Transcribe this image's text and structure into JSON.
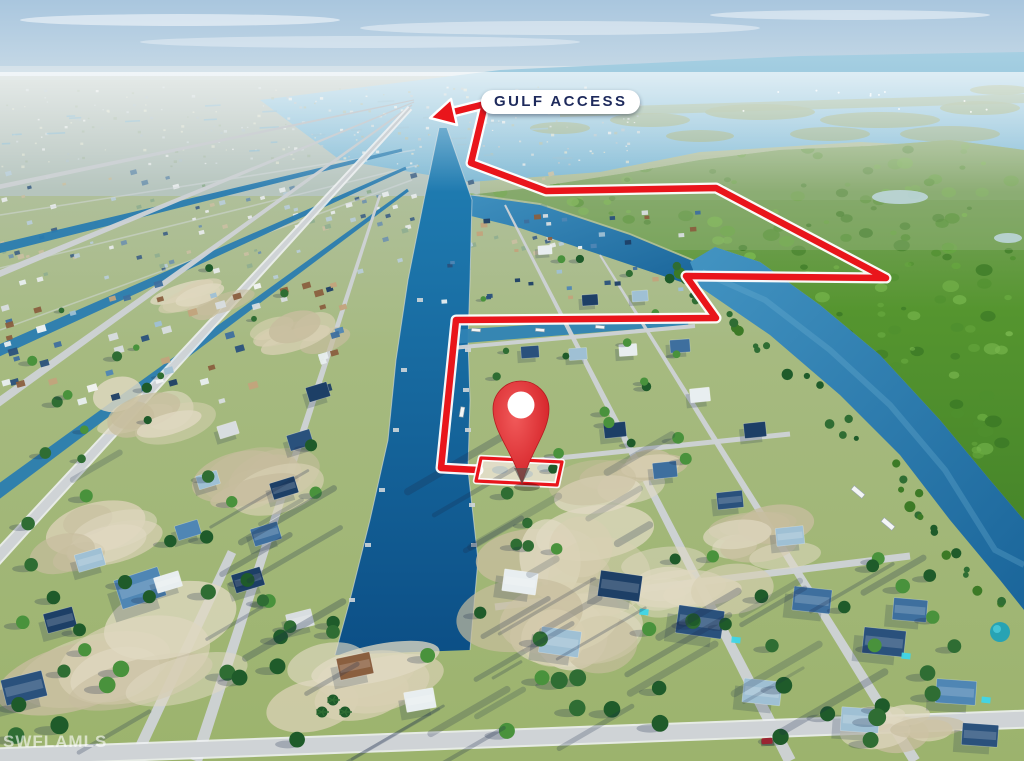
{
  "annotations": {
    "gulf_access_label": "GULF ACCESS",
    "watermark": "SWFLAMLS"
  },
  "colors": {
    "route_red": "#e9151b",
    "casing_white": "#ffffff",
    "label_text": "#1e2a5c",
    "label_bg": "#ffffff",
    "pin_red": "#e02a2e",
    "pin_red_dark": "#b51b20",
    "pin_tip": "#57514d",
    "pin_inner": "#ffffff",
    "watermark": "rgba(255,255,255,0.6)",
    "sky_top": "#a9c6de",
    "bay_blue": "#8fc2dc",
    "canal_blue": "#0f5a8f",
    "river_blue": "#2a80b2",
    "preserve_green": "#55952f",
    "land_green": "#a6ba80",
    "street_grey": "#cdd2d5",
    "curb_white": "#eef1f2",
    "sand": "#d8d0b3",
    "sand_dark": "#c7bd9e",
    "shadow": "rgba(26,43,74,0.25)",
    "tree_green": "#2f6d33",
    "car_red": "#c4232a"
  },
  "overlay": {
    "route_points": [
      [
        441,
        115
      ],
      [
        485,
        104
      ],
      [
        471,
        163
      ],
      [
        546,
        191
      ],
      [
        716,
        188
      ],
      [
        886,
        278
      ],
      [
        686,
        276
      ],
      [
        716,
        318
      ],
      [
        456,
        320
      ],
      [
        441,
        468
      ],
      [
        478,
        470
      ]
    ],
    "arrow_head": [
      [
        430,
        118
      ],
      [
        451,
        99
      ],
      [
        457,
        125
      ]
    ],
    "lot_outline": [
      [
        481,
        458
      ],
      [
        562,
        462
      ],
      [
        557,
        485
      ],
      [
        476,
        481
      ]
    ],
    "pin": {
      "cx": 521,
      "cy": 409,
      "r": 28,
      "inner_r": 13.5,
      "tip_x": 522,
      "tip_y": 484
    }
  },
  "scene": {
    "clouds": [
      [
        180,
        20,
        160,
        6,
        0.5
      ],
      [
        560,
        28,
        200,
        7,
        0.4
      ],
      [
        850,
        15,
        140,
        5,
        0.45
      ],
      [
        360,
        42,
        220,
        6,
        0.35
      ]
    ],
    "bay": [
      [
        260,
        100
      ],
      [
        500,
        70
      ],
      [
        800,
        56
      ],
      [
        1024,
        52
      ],
      [
        1024,
        150
      ],
      [
        860,
        142
      ],
      [
        700,
        152
      ],
      [
        600,
        172
      ],
      [
        470,
        182
      ],
      [
        340,
        160
      ]
    ],
    "shoreline": [
      [
        560,
        108
      ],
      [
        1024,
        94
      ],
      [
        1024,
        103
      ],
      [
        560,
        117
      ]
    ],
    "islands": [
      [
        650,
        120,
        40,
        7
      ],
      [
        760,
        112,
        55,
        8
      ],
      [
        880,
        120,
        60,
        8
      ],
      [
        980,
        108,
        40,
        7
      ],
      [
        560,
        128,
        30,
        6
      ],
      [
        700,
        136,
        34,
        6
      ],
      [
        830,
        134,
        40,
        7
      ],
      [
        950,
        134,
        50,
        8
      ],
      [
        1000,
        90,
        30,
        5
      ],
      [
        590,
        100,
        26,
        5
      ]
    ],
    "preserve": [
      [
        432,
        188
      ],
      [
        540,
        203
      ],
      [
        630,
        233
      ],
      [
        695,
        260
      ],
      [
        715,
        247
      ],
      [
        760,
        262
      ],
      [
        820,
        305
      ],
      [
        880,
        355
      ],
      [
        940,
        420
      ],
      [
        990,
        480
      ],
      [
        1024,
        520
      ],
      [
        1024,
        150
      ],
      [
        950,
        140
      ],
      [
        870,
        146
      ],
      [
        780,
        150
      ],
      [
        700,
        160
      ],
      [
        620,
        174
      ],
      [
        530,
        188
      ],
      [
        460,
        196
      ]
    ],
    "ponds": [
      [
        668,
        152,
        16,
        5
      ],
      [
        900,
        197,
        28,
        7
      ],
      [
        1008,
        238,
        14,
        5
      ],
      [
        648,
        142,
        10,
        4
      ]
    ],
    "marsh_mute": [
      [
        430,
        140,
        594,
        110,
        0.35
      ],
      [
        600,
        140,
        424,
        60,
        0.3
      ]
    ],
    "upper_canal": [
      [
        432,
        190
      ],
      [
        540,
        205
      ],
      [
        630,
        235
      ],
      [
        695,
        262
      ],
      [
        690,
        285
      ],
      [
        610,
        258
      ],
      [
        520,
        228
      ],
      [
        430,
        206
      ]
    ],
    "river": {
      "left": [
        [
          690,
          262
        ],
        [
          700,
          287
        ],
        [
          770,
          335
        ],
        [
          840,
          395
        ],
        [
          900,
          455
        ],
        [
          950,
          520
        ],
        [
          1000,
          580
        ],
        [
          1024,
          610
        ]
      ],
      "right": [
        [
          1024,
          520
        ],
        [
          990,
          480
        ],
        [
          940,
          420
        ],
        [
          880,
          355
        ],
        [
          820,
          305
        ],
        [
          760,
          262
        ],
        [
          715,
          247
        ]
      ],
      "center": [
        [
          702,
          272
        ],
        [
          765,
          300
        ],
        [
          830,
          350
        ],
        [
          890,
          405
        ],
        [
          945,
          470
        ],
        [
          995,
          550
        ],
        [
          1024,
          565
        ]
      ]
    },
    "central_canal": {
      "left": [
        [
          439,
          128
        ],
        [
          424,
          200
        ],
        [
          408,
          280
        ],
        [
          396,
          360
        ],
        [
          388,
          440
        ],
        [
          370,
          520
        ],
        [
          350,
          600
        ],
        [
          335,
          655
        ]
      ],
      "right": [
        [
          447,
          128
        ],
        [
          472,
          200
        ],
        [
          470,
          280
        ],
        [
          468,
          340
        ],
        [
          470,
          400
        ],
        [
          468,
          470
        ],
        [
          478,
          560
        ],
        [
          470,
          650
        ]
      ]
    },
    "canal_strips": [
      [
        [
          402,
          150
        ],
        [
          -40,
          258
        ],
        3,
        10
      ],
      [
        [
          406,
          168
        ],
        [
          -40,
          368
        ],
        3,
        12
      ],
      [
        [
          408,
          190
        ],
        [
          -40,
          520
        ],
        3,
        14
      ],
      [
        [
          452,
          337
        ],
        [
          688,
          320
        ],
        14,
        10
      ]
    ],
    "faint_cross_streets": [
      [
        [
          0,
          215
        ],
        [
          415,
          150
        ]
      ],
      [
        [
          0,
          268
        ],
        [
          418,
          165
        ]
      ],
      [
        [
          0,
          330
        ],
        [
          412,
          180
        ]
      ]
    ],
    "streets": [
      [
        [
          414,
          100
        ],
        [
          -40,
          195
        ],
        1,
        5,
        0
      ],
      [
        [
          414,
          102
        ],
        [
          -40,
          290
        ],
        1,
        7,
        0
      ],
      [
        [
          412,
          105
        ],
        [
          -40,
          430
        ],
        1.5,
        9,
        0
      ],
      [
        [
          410,
          108
        ],
        [
          -60,
          620
        ],
        2,
        11,
        1
      ],
      [
        [
          380,
          195
        ],
        [
          196,
          761
        ],
        2.5,
        12,
        0
      ],
      [
        [
          232,
          552
        ],
        [
          138,
          752
        ],
        9,
        11,
        0
      ],
      [
        [
          505,
          205
        ],
        [
          790,
          761
        ],
        2,
        12,
        0
      ],
      [
        [
          600,
          255
        ],
        [
          915,
          761
        ],
        2,
        11,
        0
      ],
      [
        [
          452,
          348
        ],
        [
          695,
          326
        ],
        4,
        4,
        0
      ],
      [
        [
          462,
          468
        ],
        [
          790,
          434
        ],
        5,
        5,
        0
      ],
      [
        [
          495,
          607
        ],
        [
          910,
          556
        ],
        7,
        7,
        0
      ],
      [
        [
          -5,
          757
        ],
        [
          1029,
          719
        ],
        15,
        15,
        1
      ]
    ],
    "sand_zones": [
      [
        130,
        650,
        120,
        55,
        -15
      ],
      [
        360,
        690,
        100,
        45,
        -12
      ],
      [
        555,
        545,
        80,
        55,
        -8
      ],
      [
        565,
        640,
        90,
        50,
        -8
      ],
      [
        700,
        580,
        70,
        35,
        -6
      ],
      [
        245,
        480,
        70,
        35,
        -16
      ],
      [
        150,
        410,
        60,
        30,
        -16
      ],
      [
        80,
        540,
        70,
        35,
        -15
      ],
      [
        620,
        480,
        60,
        30,
        -8
      ],
      [
        760,
        540,
        55,
        28,
        -6
      ],
      [
        300,
        330,
        50,
        22,
        -18
      ],
      [
        200,
        300,
        45,
        20,
        -18
      ],
      [
        905,
        720,
        60,
        25,
        -4
      ]
    ],
    "roof_palette": [
      "#1d3f66",
      "#2a517c",
      "#3e6f9e",
      "#4f86b4",
      "#9fc0d4",
      "#e8eef0",
      "#f2f4f4",
      "#c2a37c",
      "#8a5f3f",
      "#d8dde0"
    ],
    "houses": [
      [
        140,
        588,
        46,
        30,
        -18,
        3
      ],
      [
        24,
        688,
        42,
        26,
        -14,
        1
      ],
      [
        355,
        666,
        34,
        22,
        -12,
        8
      ],
      [
        620,
        586,
        42,
        26,
        8,
        0
      ],
      [
        700,
        622,
        46,
        28,
        8,
        1
      ],
      [
        560,
        642,
        40,
        26,
        8,
        4
      ],
      [
        812,
        600,
        38,
        24,
        6,
        2
      ],
      [
        884,
        642,
        42,
        26,
        6,
        1
      ],
      [
        956,
        692,
        40,
        24,
        4,
        3
      ],
      [
        762,
        692,
        38,
        24,
        6,
        4
      ],
      [
        520,
        582,
        34,
        22,
        8,
        5
      ],
      [
        318,
        392,
        22,
        15,
        -17,
        0
      ],
      [
        300,
        440,
        24,
        16,
        -17,
        1
      ],
      [
        284,
        488,
        26,
        17,
        -17,
        0
      ],
      [
        266,
        534,
        28,
        18,
        -17,
        2
      ],
      [
        248,
        580,
        30,
        19,
        -17,
        0
      ],
      [
        228,
        430,
        20,
        13,
        -17,
        9
      ],
      [
        208,
        480,
        22,
        14,
        -17,
        4
      ],
      [
        188,
        530,
        24,
        15,
        -17,
        3
      ],
      [
        168,
        582,
        26,
        16,
        -17,
        5
      ],
      [
        530,
        352,
        18,
        12,
        -4,
        1
      ],
      [
        578,
        354,
        18,
        12,
        -4,
        4
      ],
      [
        628,
        350,
        18,
        12,
        -4,
        5
      ],
      [
        680,
        346,
        20,
        13,
        -4,
        2
      ],
      [
        590,
        300,
        16,
        11,
        -4,
        0
      ],
      [
        640,
        296,
        16,
        11,
        -4,
        4
      ],
      [
        545,
        250,
        14,
        9,
        -4,
        5
      ],
      [
        615,
        430,
        22,
        15,
        -6,
        0
      ],
      [
        665,
        470,
        24,
        16,
        -6,
        2
      ],
      [
        730,
        500,
        26,
        17,
        -6,
        1
      ],
      [
        790,
        536,
        28,
        18,
        -6,
        4
      ],
      [
        700,
        395,
        20,
        14,
        -6,
        5
      ],
      [
        755,
        430,
        22,
        15,
        -6,
        0
      ],
      [
        910,
        610,
        34,
        22,
        5,
        2
      ],
      [
        980,
        735,
        36,
        22,
        4,
        1
      ],
      [
        860,
        720,
        38,
        24,
        4,
        4
      ],
      [
        420,
        700,
        30,
        20,
        -10,
        5
      ],
      [
        300,
        620,
        26,
        17,
        -14,
        9
      ],
      [
        90,
        560,
        28,
        18,
        -16,
        4
      ],
      [
        60,
        620,
        30,
        20,
        -15,
        0
      ]
    ],
    "pools": [
      [
        736,
        640
      ],
      [
        906,
        656
      ],
      [
        986,
        700
      ],
      [
        644,
        612
      ]
    ],
    "dome": [
      1000,
      632,
      10
    ],
    "boats": [
      [
        462,
        412,
        10,
        4,
        -80
      ],
      [
        858,
        492,
        14,
        5,
        40
      ],
      [
        888,
        524,
        14,
        5,
        40
      ],
      [
        476,
        330,
        9,
        3,
        5
      ],
      [
        540,
        330,
        9,
        3,
        5
      ],
      [
        600,
        327,
        9,
        3,
        5
      ]
    ],
    "car": [
      767,
      741
    ],
    "palms": [
      [
        333,
        700
      ],
      [
        345,
        712
      ],
      [
        322,
        712
      ]
    ]
  }
}
